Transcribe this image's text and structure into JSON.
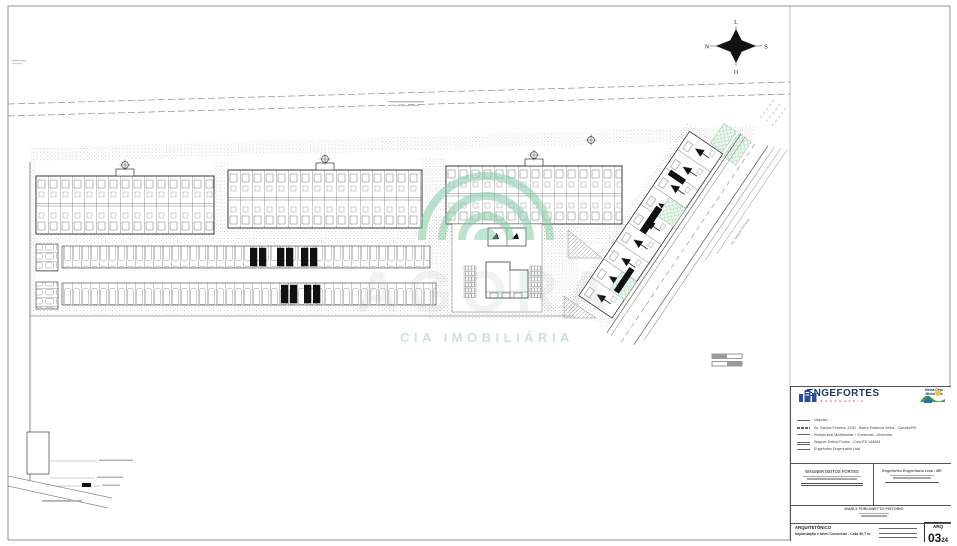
{
  "compass": {
    "top": "L",
    "right": "S",
    "bottom": "O",
    "left": "N"
  },
  "watermark": {
    "brand": "AGORA",
    "subtitle": "CIA IMOBILIÁRIA"
  },
  "avenue_label": "Av. Santos Ferreira",
  "title_block": {
    "company": {
      "name": "ENGEFORTES",
      "tagline": "ENGENHARIA"
    },
    "program": {
      "line1": "Minha Casa",
      "line2": "Minha Vida"
    },
    "legend": [
      "Nápoles",
      "Av. Santos Ferreira, 4200 - Bairro Estância Velha - Canoas/RS",
      "Residencial Multifamiliar / Comercial - Alvenaria",
      "Wagner Deitos Fortes - Crea RS 169684",
      "Engefortes Engenharia Ltda"
    ],
    "sign_left": {
      "name": "WAGNER DEITOS FORTES"
    },
    "sign_right": {
      "name": "Engefortes Engenharia Ltda - ME"
    },
    "sign_center": {
      "name": "MARLY FURLANETTO PISTORIO"
    },
    "sheet": {
      "discipline": "ARQUITETÔNICO",
      "subject": "Implantação e Nível Comercial - Cota 36,7 m",
      "code": "ARQ",
      "number": "03",
      "total": "24"
    }
  }
}
